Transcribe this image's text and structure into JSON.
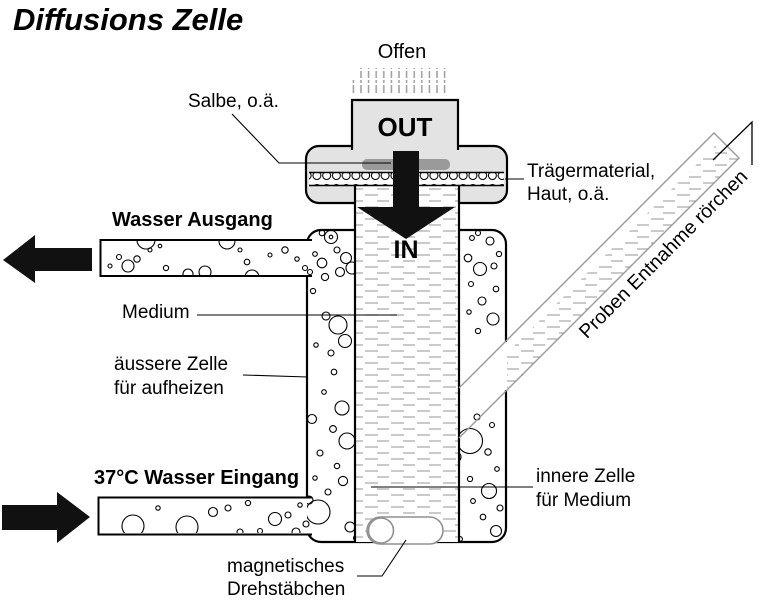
{
  "title": "Diffusions Zelle",
  "top": {
    "offen": "Offen",
    "salbe": "Salbe, o.ä.",
    "out": "OUT",
    "in": "IN"
  },
  "labels": {
    "traegermaterial_line1": "Trägermaterial,",
    "traegermaterial_line2": "Haut, o.ä.",
    "wasser_ausgang": "Wasser Ausgang",
    "medium": "Medium",
    "aeussere_zelle_line1": "äussere Zelle",
    "aeussere_zelle_line2": "für aufheizen",
    "proben_tube": "Proben Entnahme rörchen",
    "wasser_eingang": "37°C Wasser Eingang",
    "innere_zelle_line1": "innere Zelle",
    "innere_zelle_line2": "für Medium",
    "magnet_line1": "magnetisches",
    "magnet_line2": "Drehstäbchen"
  },
  "colors": {
    "cell_fill": "#e3e3e3",
    "smudge": "#9a9a9a",
    "tube_stroke": "#999999",
    "liquid_dash": "#a9a9a9",
    "outline": "#000000"
  }
}
